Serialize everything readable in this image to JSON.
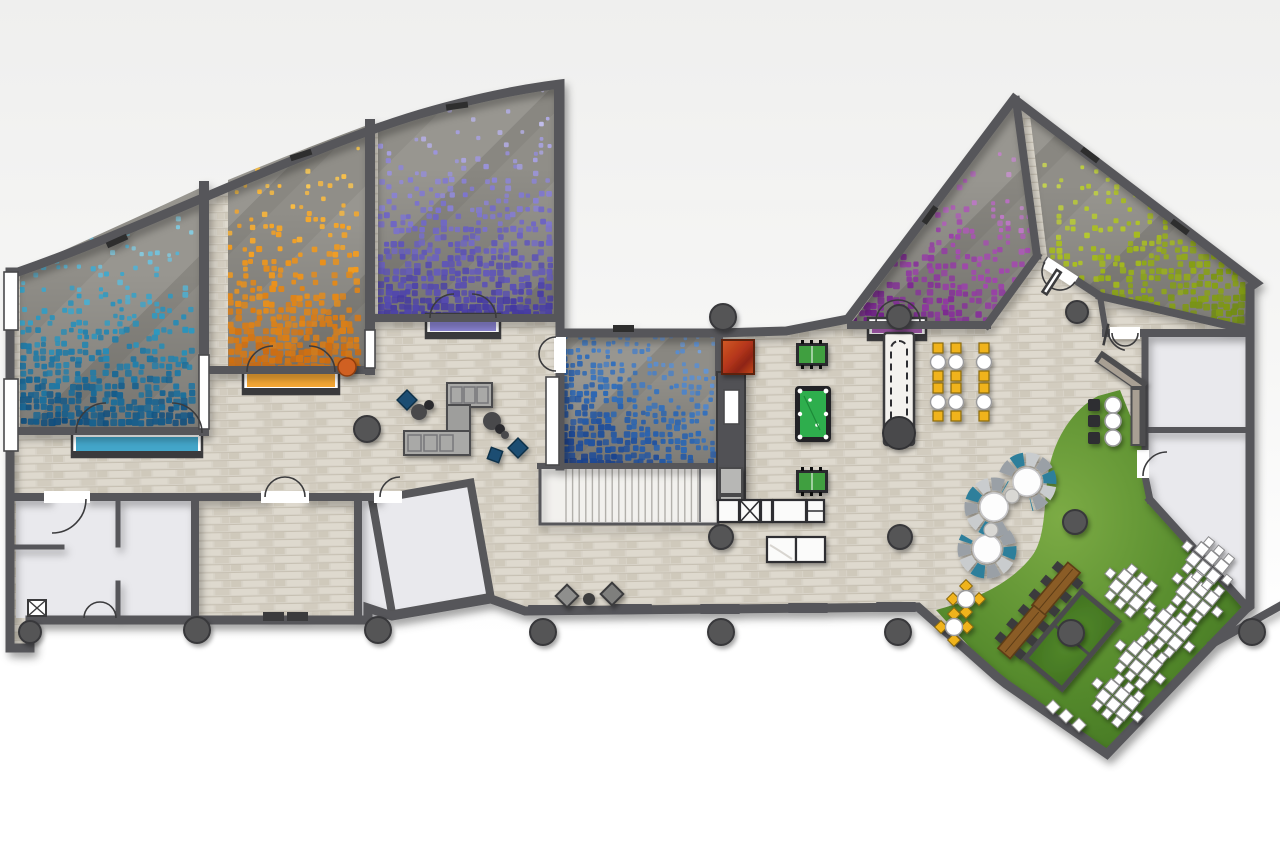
{
  "canvas": {
    "width": 1280,
    "height": 853
  },
  "palette": {
    "bgTop": "#efefee",
    "bgBot": "#ffffff",
    "wall": "#57575a",
    "wallDark": "#3a3a3c",
    "stoneBg": "#d8d3c8",
    "brickA": "#ded9ce",
    "brickB": "#d2ccbf",
    "brickC": "#cfc9bb",
    "brickLine": "#c3bcae",
    "carpet": "#908e88",
    "carpetDark": "#76746f",
    "roomWhite": "#e9e9ed",
    "white": "#ffffff",
    "grassA": "#7cab45",
    "grassB": "#558a2c",
    "grassC": "#3c6e1e",
    "wood": "#8a5c28",
    "woodDark": "#5d3c14",
    "felt": "#2fae4e",
    "feltDark": "#157f32",
    "foos": "#44a348",
    "sofaGray": "#a9a9a7",
    "sofaRed": "#b5361d",
    "poufBlue": "#1e4e72",
    "poufGray": "#8f8f8d",
    "stoolYellow": "#f0b31c",
    "boothTeal": "#2e7f9b",
    "boothGray": "#9aa0a6",
    "boothLight": "#c9ccce",
    "column": "#545456",
    "board": "#f4f2ee"
  },
  "mosaic_rooms": [
    {
      "id": "cyan-carpet-room",
      "light": "#b8e6f0",
      "mid": "#2f9cc4",
      "deep": "#0f4e7e",
      "dir": "down",
      "base": 0.05,
      "gain": 0.95,
      "pow": 1.6
    },
    {
      "id": "amber-carpet-room",
      "light": "#ffdf6e",
      "mid": "#f49d1e",
      "deep": "#cd6c10",
      "dir": "down",
      "base": 0.05,
      "gain": 0.95,
      "pow": 1.6
    },
    {
      "id": "violet-carpet-room",
      "light": "#d0ccf2",
      "mid": "#8078cf",
      "deep": "#453aa2",
      "dir": "down",
      "base": 0.07,
      "gain": 0.95,
      "pow": 1.5
    },
    {
      "id": "blue-carpet-room",
      "light": "#7fa9e0",
      "mid": "#2f6cb8",
      "deep": "#163a85",
      "dir": "down-left",
      "base": 0.35,
      "gain": 0.62,
      "pow": 1.1
    },
    {
      "id": "magenta-carpet-room",
      "light": "#ddbde4",
      "mid": "#a850b2",
      "deep": "#6d1c86",
      "dir": "down-left",
      "base": 0.04,
      "gain": 0.95,
      "pow": 1.7
    },
    {
      "id": "lime-carpet-room",
      "light": "#dde96a",
      "mid": "#aabf20",
      "deep": "#6e8a0e",
      "dir": "down-right",
      "base": 0.04,
      "gain": 0.95,
      "pow": 1.7
    }
  ],
  "furniture_colors": {
    "pool_table_felt": "#2fae4e",
    "foosball_felt": "#3f9f3f",
    "shuffleboard_top": "#f4f2ee",
    "picnic_wood": "#8a5c28",
    "stool_yellow": "#f0b31c",
    "pouf_blue": "#1e4e72",
    "sofa_gray": "#a9a9a7",
    "lounge_sofa_red": "#b5361d",
    "booth_teal": "#2e7f9b",
    "grass": "#558a2c"
  },
  "counts": {
    "mosaic_carpet_rooms": 6,
    "hightop_tables": 6,
    "bar_stools": 3,
    "circular_booths": 3,
    "outdoor_dining_sets": 6,
    "picnic_tables": 2,
    "outdoor_cafe_tables": 2,
    "foosball_tables": 2,
    "pool_tables": 1,
    "shuffleboard_tables": 1,
    "columns": 14
  }
}
